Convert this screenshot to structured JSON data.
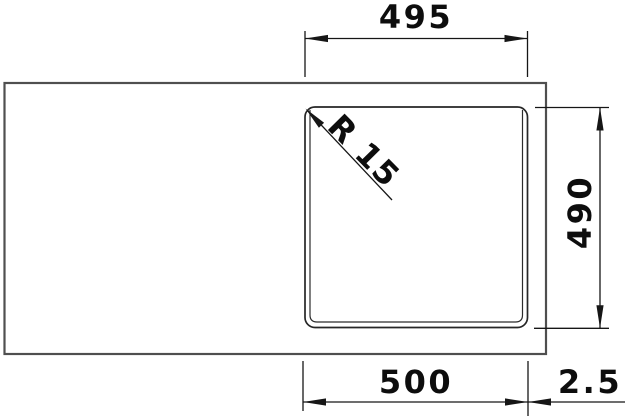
{
  "drawing": {
    "type": "sink-dimension-top-view",
    "dimensions": {
      "top_width_label": "495",
      "right_depth_label": "490",
      "bottom_width_label": "500",
      "right_gap_label": "2.5",
      "corner_radius_label": "R 15"
    },
    "colors": {
      "background": "#ffffff",
      "dimension_line": "#161616",
      "sink_outline": "#4f4f4f",
      "bowl_outline": "#262626",
      "text": "#0d0d0d"
    }
  }
}
